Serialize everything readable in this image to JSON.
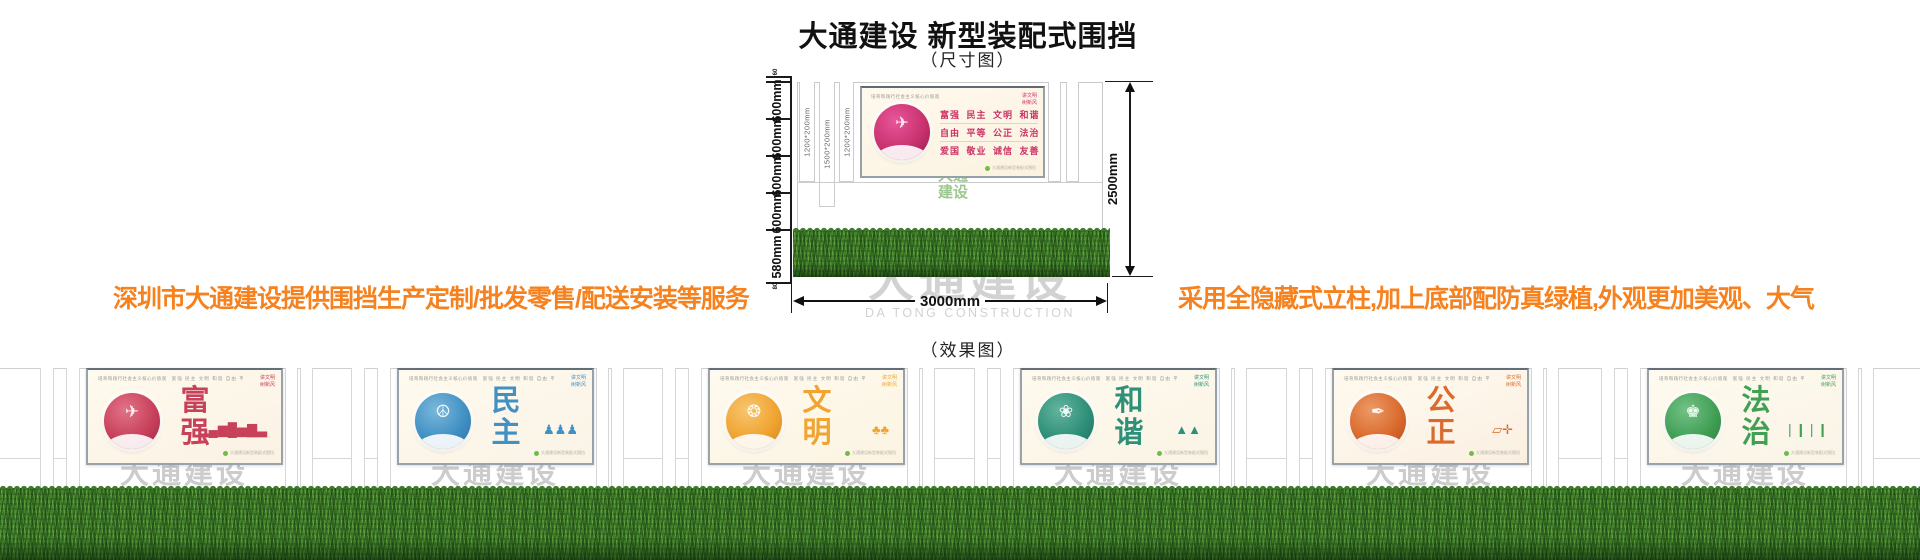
{
  "page": {
    "title": "大通建设 新型装配式围挡",
    "dimension_caption": "（尺寸图）",
    "effect_caption": "（效果图）",
    "left_tagline": "深圳市大通建设提供围挡生产定制/批发零售/配送安装等服务",
    "right_tagline": "采用全隐藏式立柱,加上底部配防真绿植,外观更加美观、大气",
    "tagline_color": "#F5821F"
  },
  "watermark": {
    "cn": "大通建设",
    "en": "DA TONG CONSTRUCTION"
  },
  "panel_shared": {
    "header_left": "培育和践行社会主义核心价值观",
    "header_values": "富强 民主 文明 和谐 自由 平等 公正 法治 爱国 敬业 诚信 友善",
    "slogan1": "讲文明",
    "slogan2": "树新风",
    "footnote": "大通建设新型装配式围挡"
  },
  "dimension_diagram": {
    "total_height_label": "2500mm",
    "total_width_label": "3000mm",
    "segment_labels": [
      "600mm",
      "600mm",
      "600mm",
      "600mm",
      "580mm"
    ],
    "small_top_label": "60",
    "small_bottom_label": "80",
    "post_labels": [
      "1200*200mm",
      "1500*200mm",
      "1200*200mm"
    ],
    "green_logo": "大通建设",
    "panel": {
      "header": "培育和践行社会主义核心价值观",
      "rows": [
        "富强 民主 文明 和谐",
        "自由 平等 公正 法治",
        "爱国 敬业 诚信 友善"
      ],
      "theme_color": "#CC3366"
    }
  },
  "effect_panels": [
    {
      "word": "富强",
      "color": "#C8415B",
      "color_light": "#E27288",
      "color_dark": "#9E2345",
      "bg": "#FAF2E3",
      "circle_glyph": "✈",
      "right_icon": "▂▄▆█▅▇▃",
      "icon_name": "prosperity-papercut-icon",
      "right_icon_name": "city-skyline-icon"
    },
    {
      "word": "民主",
      "color": "#4191C4",
      "color_light": "#7BB8DB",
      "color_dark": "#2B6E9E",
      "bg": "#FAF3E6",
      "circle_glyph": "☮",
      "right_icon": "♟♟♟",
      "icon_name": "democracy-papercut-icon",
      "right_icon_name": "people-figures-icon"
    },
    {
      "word": "文明",
      "color": "#F0A431",
      "color_light": "#F7C671",
      "color_dark": "#D28414",
      "bg": "#FBF4E2",
      "circle_glyph": "❂",
      "right_icon": "♣♣",
      "icon_name": "civility-papercut-icon",
      "right_icon_name": "trees-icon"
    },
    {
      "word": "和谐",
      "color": "#2F9079",
      "color_light": "#63B49E",
      "color_dark": "#1D6B58",
      "bg": "#F9F4E4",
      "circle_glyph": "❀",
      "right_icon": "▲▲",
      "icon_name": "harmony-papercut-icon",
      "right_icon_name": "mountains-icon"
    },
    {
      "word": "公正",
      "color": "#DA6B2E",
      "color_light": "#EC9A66",
      "color_dark": "#B44A14",
      "bg": "#FAF0E2",
      "circle_glyph": "✒",
      "right_icon": "▱✛",
      "icon_name": "justice-papercut-icon",
      "right_icon_name": "book-gavel-icon"
    },
    {
      "word": "法治",
      "color": "#41A055",
      "color_light": "#74C186",
      "color_dark": "#2A7A3C",
      "bg": "#F9F4E6",
      "circle_glyph": "♚",
      "right_icon": "❘❙❘❙",
      "icon_name": "rule-of-law-papercut-icon",
      "right_icon_name": "bamboo-icon"
    }
  ]
}
